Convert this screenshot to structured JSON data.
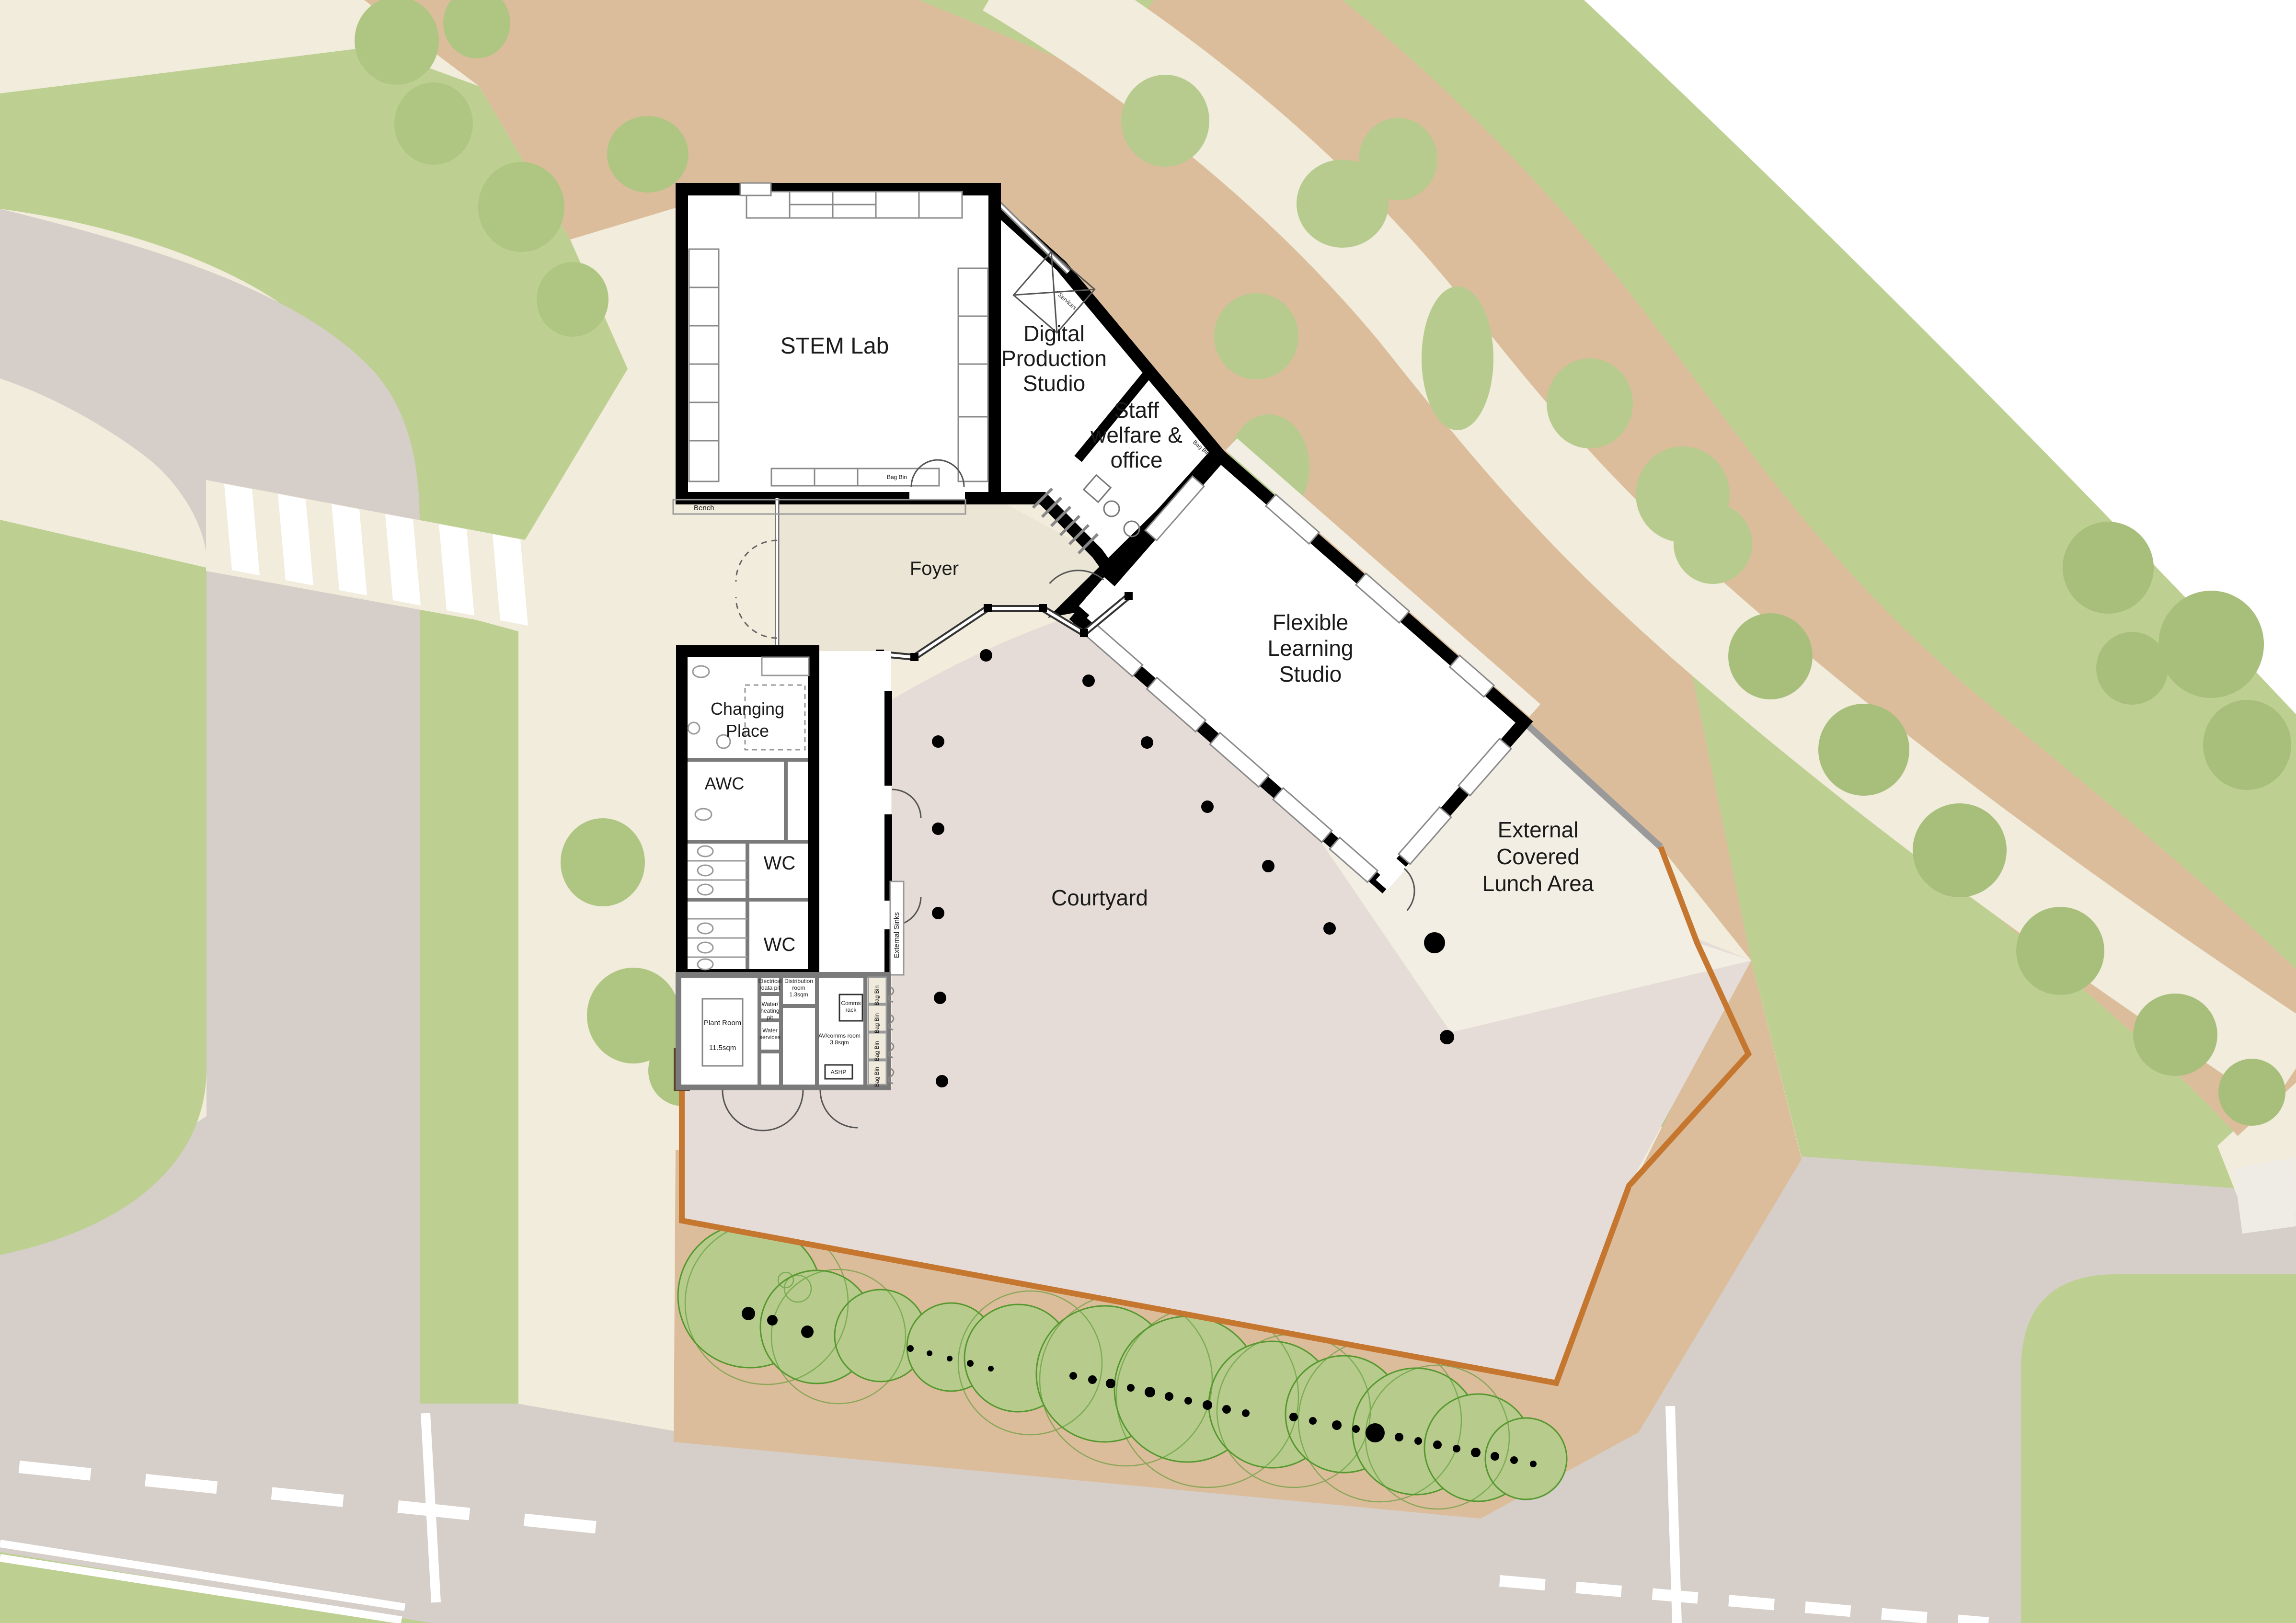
{
  "plan": {
    "title_hint": "School building site plan",
    "rooms": {
      "stem_lab": "STEM Lab",
      "digital": "Digital\nProduction\nStudio",
      "staff_welfare": "Staff\nwelfare &\noffice",
      "foyer": "Foyer",
      "flexible": "Flexible\nLearning\nStudio",
      "changing_place": "Changing\nPlace",
      "awc": "AWC",
      "wc": "WC"
    },
    "outdoor": {
      "courtyard": "Courtyard",
      "lunch_area": "External\nCovered\nLunch Area"
    },
    "annotations": {
      "bench": "Bench",
      "bag_bin": "Bag Bin",
      "external_sinks": "External Sinks",
      "services": "Services"
    },
    "service_rooms": {
      "plant_room": "Plant Room",
      "plant_room_area": "11.5sqm",
      "electrical_pit": "Electrical\n/data pit",
      "water_heating_pit": "Water/\nheating\npit",
      "water_services": "Water\nservices",
      "distribution_room": "Distribution\nroom\n1.3sqm",
      "comms_rack": "Comms\nrack",
      "av_comms_room": "AV/comms room\n3.8sqm",
      "ashp": "ASHP"
    },
    "colors": {
      "grass": "#bdd092",
      "tree_canopy": "#afc682",
      "tree_outline": "#56982f",
      "mulch": "#dcbd9b",
      "path_cream": "#f1ecdb",
      "road_gray": "#d6cec8",
      "courtyard_pink": "#e6dcd7",
      "lunch_cream": "#f2eee3",
      "wall_black": "#000000",
      "service_wall": "#7a7a7a",
      "fence_orange": "#c5762f",
      "road_marking": "#ffffff"
    }
  }
}
